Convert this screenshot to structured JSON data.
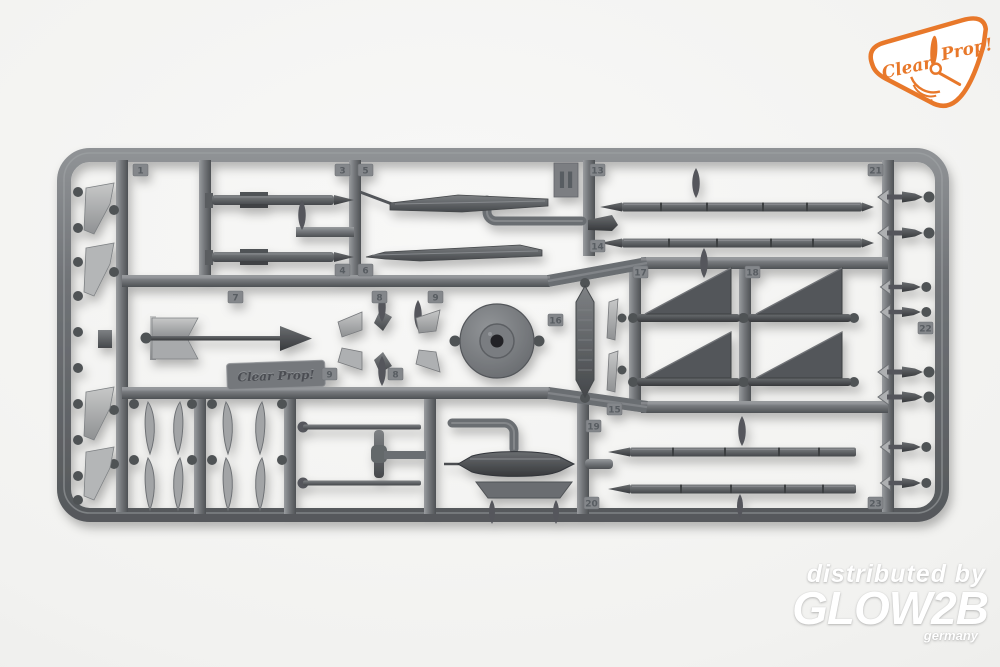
{
  "photo": {
    "subject": "Injection-molded plastic model kit sprue with aircraft armament parts: missiles, rockets, bombs, drop tank, fins, pylons and a disc part",
    "background_color": "#f1f1ef",
    "plastic_color": "#6e7175"
  },
  "brand_logo": {
    "word1": "Clear",
    "word2": "Prop!",
    "color": "#e8782a"
  },
  "sprue": {
    "id_label": "II",
    "embossed_label": "Clear Prop!",
    "part_tabs": [
      "1",
      "3",
      "5",
      "13",
      "21",
      "7",
      "4",
      "6",
      "8",
      "9",
      "9",
      "8",
      "14",
      "16",
      "17",
      "18",
      "15",
      "19",
      "20",
      "22",
      "23"
    ]
  },
  "watermark": {
    "line1": "distributed by",
    "line2": "GLOW2B",
    "line3": "germany",
    "color": "#ffffff"
  }
}
